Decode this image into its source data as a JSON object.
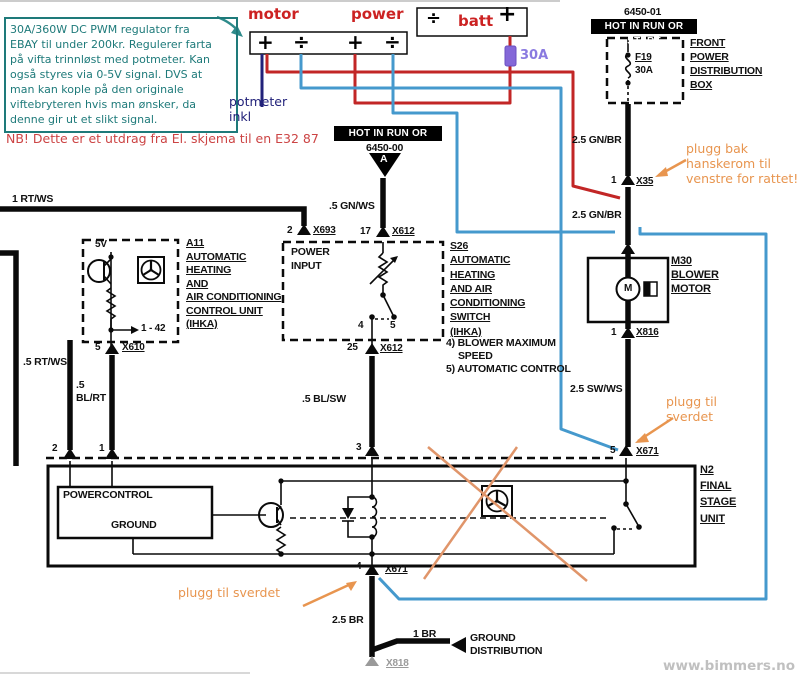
{
  "colors": {
    "teal": "#1e7a7a",
    "note_red": "#cc4444",
    "label_red": "#cc2222",
    "wire_red": "#c22626",
    "wire_blue": "#4599cd",
    "wire_navy": "#22227a",
    "orange": "#e8954f",
    "fuse_purple": "#8468d8",
    "site_gray": "#c0c0c0"
  },
  "annotations": {
    "info_box": "30A/360W DC PWM regulator fra\nEBAY til under 200kr. Regulerer farta\npå vifta trinnløst med potmeter. Kan\nogså styres via 0-5V signal. DVS at\nman kan kople på den originale\nviftebryteren hvis man ønsker, da\ndenne gir ut et slikt signal.",
    "nb_note": "NB! Dette er et utdrag fra El. skjema til en E32 87",
    "motor": "motor",
    "power": "power",
    "batt": "batt",
    "fuse_30a": "30A",
    "potmeter": "potmeter\ninkl",
    "plug_glovebox": "plugg bak\nhanskerom til\nvenstre for rattet!",
    "plug_sword_right": "plugg til\nsverdet",
    "plug_sword_bottom": "plugg til sverdet",
    "site": "www.bimmers.no",
    "terminals": {
      "t1": "+",
      "t2": "÷",
      "t3": "+",
      "t4": "÷",
      "batt_minus": "÷",
      "batt_plus": "+"
    }
  },
  "diagram": {
    "front_box": {
      "part_no": "6450-01",
      "badge": "HOT IN RUN OR START",
      "fuse_name": "F19",
      "fuse_rating": "30A",
      "label": "FRONT\nPOWER\nDISTRIBUTION\nBOX"
    },
    "feed": {
      "part_no": "6450-00",
      "badge": "HOT IN RUN OR START",
      "tri": "A"
    },
    "wires": {
      "rt_ws_1": "1 RT/WS",
      "gn_ws": ".5 GN/WS",
      "gn_br_1": "2.5 GN/BR",
      "gn_br_2": "2.5 GN/BR",
      "sw_ws": "2.5 SW/WS",
      "rt_ws_05": ".5 RT/WS",
      "bl_rt": ".5\nBL/RT",
      "bl_sw": ".5 BL/SW",
      "br_25": "2.5 BR",
      "br_1": "1 BR"
    },
    "connectors": {
      "x693": {
        "pin": "2",
        "name": "X693"
      },
      "x612_17": {
        "pin": "17",
        "name": "X612"
      },
      "x612_25": {
        "pin": "25",
        "name": "X612"
      },
      "x610": {
        "pin": "5",
        "name": "X610"
      },
      "x35": {
        "pin": "1",
        "name": "X35"
      },
      "x817": {
        "pin": "1",
        "name": "X817"
      },
      "x816": {
        "pin": "1",
        "name": "X816"
      },
      "x671_5": {
        "pin": "5",
        "name": "X671"
      },
      "x671_4": {
        "pin": "4",
        "name": "X671"
      },
      "x818": {
        "name": "X818"
      },
      "unit_pin2": "2",
      "unit_pin1": "1",
      "unit_pin3": "3"
    },
    "a11": {
      "title": "A11\nAUTOMATIC\nHEATING\nAND\nAIR CONDITIONING\nCONTROL UNIT\n(IHKA)",
      "supply": "5V",
      "pins": "1 - 42"
    },
    "s26": {
      "title": "S26\nAUTOMATIC\nHEATING\nAND AIR\nCONDITIONING\nSWITCH\n(IHKA)",
      "power_input": "POWER\nINPUT",
      "note4": "4) BLOWER MAXIMUM",
      "note4b": "SPEED",
      "note5": "5) AUTOMATIC CONTROL",
      "pos4": "4",
      "pos5": "5"
    },
    "m30": {
      "title": "M30\nBLOWER\nMOTOR",
      "motor_letter": "M"
    },
    "n2": {
      "title": "N2\nFINAL\nSTAGE\nUNIT",
      "power": "POWER",
      "control": "CONTROL",
      "ground": "GROUND"
    },
    "ground_dist": "GROUND\nDISTRIBUTION"
  }
}
